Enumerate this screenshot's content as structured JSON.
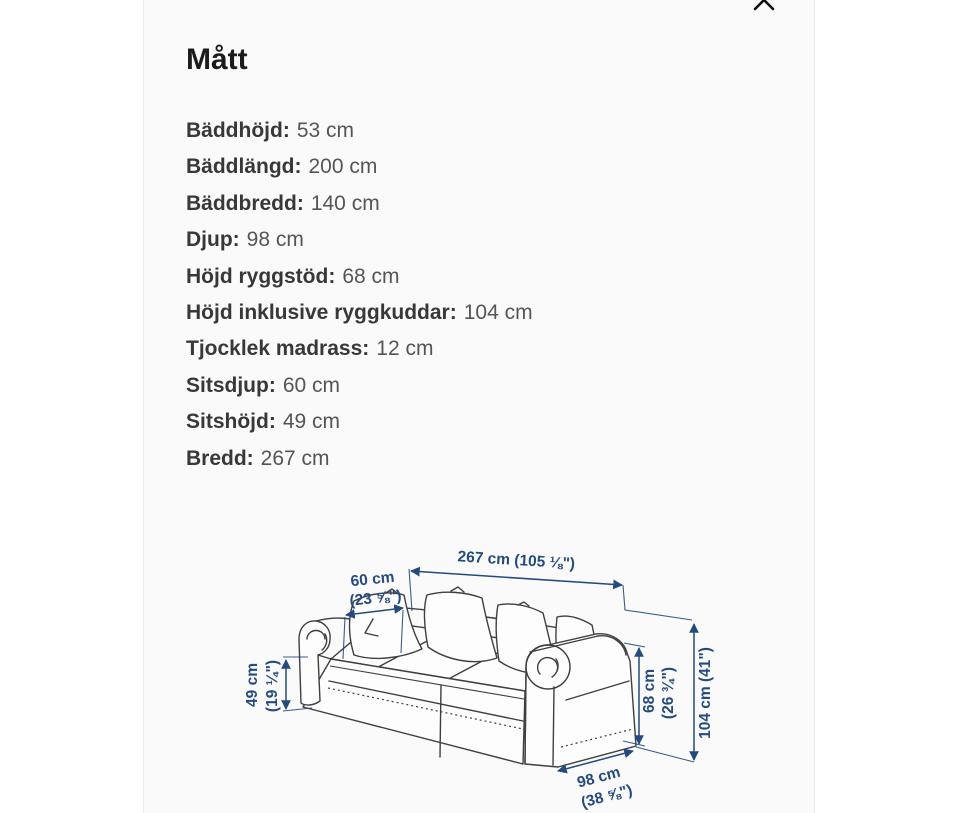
{
  "modal": {
    "title": "Mått",
    "close_icon": "x"
  },
  "measurements": [
    {
      "label": "Bäddhöjd:",
      "value": "53 cm"
    },
    {
      "label": "Bäddlängd:",
      "value": "200 cm"
    },
    {
      "label": "Bäddbredd:",
      "value": "140 cm"
    },
    {
      "label": "Djup:",
      "value": "98 cm"
    },
    {
      "label": "Höjd ryggstöd:",
      "value": "68 cm"
    },
    {
      "label": "Höjd inklusive ryggkuddar:",
      "value": "104 cm"
    },
    {
      "label": "Tjocklek madrass:",
      "value": "12 cm"
    },
    {
      "label": "Sitsdjup:",
      "value": "60 cm"
    },
    {
      "label": "Sitshöjd:",
      "value": "49 cm"
    },
    {
      "label": "Bredd:",
      "value": "267 cm"
    }
  ],
  "diagram": {
    "type": "sofa-dimension-line-drawing",
    "dimension_color": "#254a7e",
    "line_color": "#3f3f3f",
    "labels": {
      "width_total": "267 cm (105 ⅛\")",
      "seat_depth_cm": "60 cm",
      "seat_depth_in": "(23 ⅝\")",
      "seat_height_cm": "49 cm",
      "seat_height_in": "(19 ¼\")",
      "arm_height_cm": "68 cm",
      "arm_height_in": "(26 ¾\")",
      "height_total": "104 cm (41\")",
      "depth_cm": "98 cm",
      "depth_in": "(38 ⅝\")"
    }
  }
}
